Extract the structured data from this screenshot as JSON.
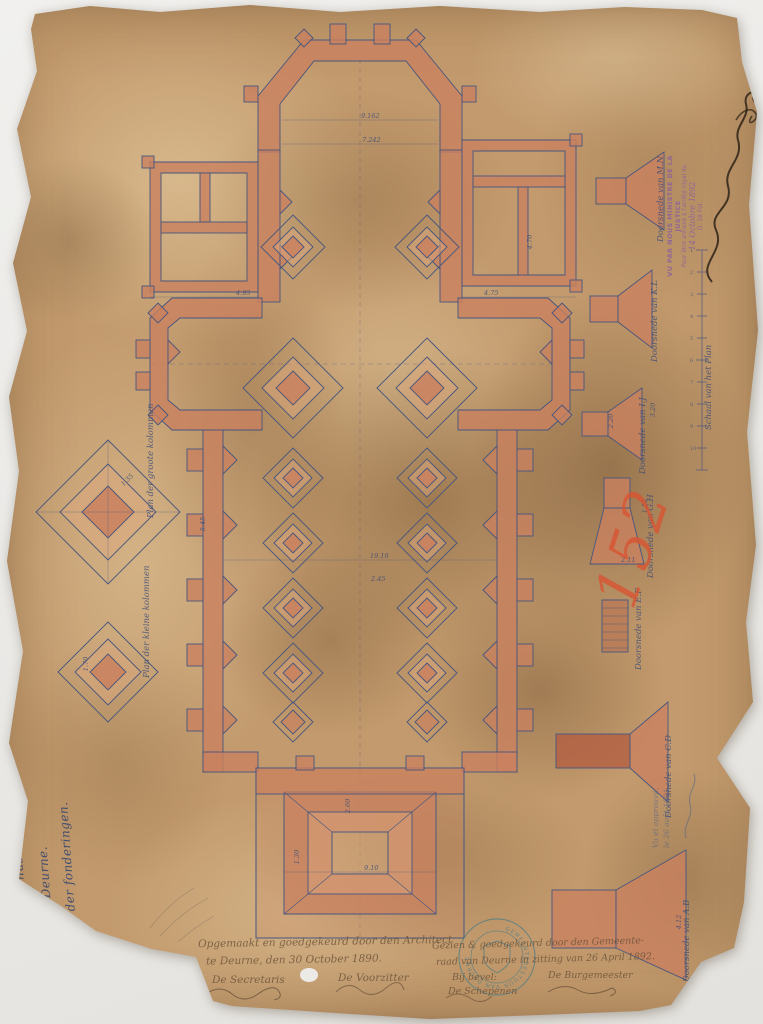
{
  "document": {
    "type_label": "Foundation plan drawing",
    "title_line1": "Kerk van den H. Rochus onder de",
    "title_line2": "gemeente Deurne.",
    "title_line3": "Plan der fonderingen.",
    "archive_number": "152"
  },
  "details_left": [
    {
      "caption": "Plan der groote kolommen"
    },
    {
      "caption": "Plan der kleine kolommen"
    }
  ],
  "sections_right": {
    "scale_label": "Schaal van het Plan",
    "scale_ticks": [
      "1",
      "2",
      "3",
      "4",
      "5",
      "6",
      "7",
      "8",
      "9",
      "10"
    ],
    "items": [
      {
        "caption": "Doorsnede van M.N"
      },
      {
        "caption": "Doorsnede van K.L"
      },
      {
        "caption": "Doorsnede van I.J"
      },
      {
        "caption": "Doorsnede van G.H"
      },
      {
        "caption": "Doorsnede van E.F"
      },
      {
        "caption": "Doorsnede van C.D"
      },
      {
        "caption": "Doorsnede van A.B"
      }
    ]
  },
  "plan": {
    "dims": [
      {
        "t": "9.162",
        "x": 361,
        "y": 112
      },
      {
        "t": "7.242",
        "x": 362,
        "y": 136
      },
      {
        "t": "4.95",
        "x": 236,
        "y": 289
      },
      {
        "t": "4.75",
        "x": 484,
        "y": 289
      },
      {
        "t": "4.70",
        "x": 523,
        "y": 238,
        "r": -90
      },
      {
        "t": "19.10",
        "x": 370,
        "y": 552
      },
      {
        "t": "2.45",
        "x": 371,
        "y": 575
      },
      {
        "t": "5.45",
        "x": 196,
        "y": 520,
        "r": -90
      },
      {
        "t": "9.10",
        "x": 364,
        "y": 864
      },
      {
        "t": "2.60",
        "x": 341,
        "y": 802,
        "r": -90
      },
      {
        "t": "1.30",
        "x": 290,
        "y": 853,
        "r": -90
      },
      {
        "t": "3.20",
        "x": 646,
        "y": 406,
        "r": -90
      },
      {
        "t": "2.20",
        "x": 604,
        "y": 417,
        "r": -90
      },
      {
        "t": "1.52",
        "x": 638,
        "y": 502,
        "r": -90
      },
      {
        "t": "2.11",
        "x": 621,
        "y": 556
      },
      {
        "t": "1.70",
        "x": 79,
        "y": 660,
        "r": -90
      },
      {
        "t": "1.35",
        "x": 120,
        "y": 476,
        "r": -45
      },
      {
        "t": "4.12",
        "x": 672,
        "y": 918,
        "r": -90
      }
    ]
  },
  "stamps": {
    "justice_line1": "VU PAR NOUS MINISTRE DE LA JUSTICE",
    "justice_line2": "Pour être annexé à l'arrêté royal du",
    "justice_line3": "14 Octobre 1892",
    "justice_line4": "D. 18 Fol.",
    "municipal_stamp_text": "GEMEENTEBESTUUR VAN DEURNE"
  },
  "inscriptions": {
    "made_line1": "Opgemaakt en goedgekeurd door den Architect",
    "made_line2": "te Deurne, den 30 October 1890.",
    "secretary_label": "De Secretaris",
    "chairman_label": "De Voorzitter",
    "approved_line1": "Gezien & goedgekeurd door den Gemeente-",
    "approved_line2": "raad van Deurne in zitting van 26 April 1892.",
    "order_label": "Bij bevel:",
    "mayor_label": "De Burgemeester",
    "aldermen_label": "De Schepenen",
    "corner_note_line1": "Vu et approuvé,",
    "corner_note_line2": "le 26 août 1891."
  },
  "colors": {
    "paper": "#c29a6d",
    "wall_wash": "#c9815f",
    "ink_blue": "#47567e",
    "red_crayon": "#d95433",
    "stamp_purple": "#8a5da0",
    "stamp_teal": "#4f7d86"
  }
}
